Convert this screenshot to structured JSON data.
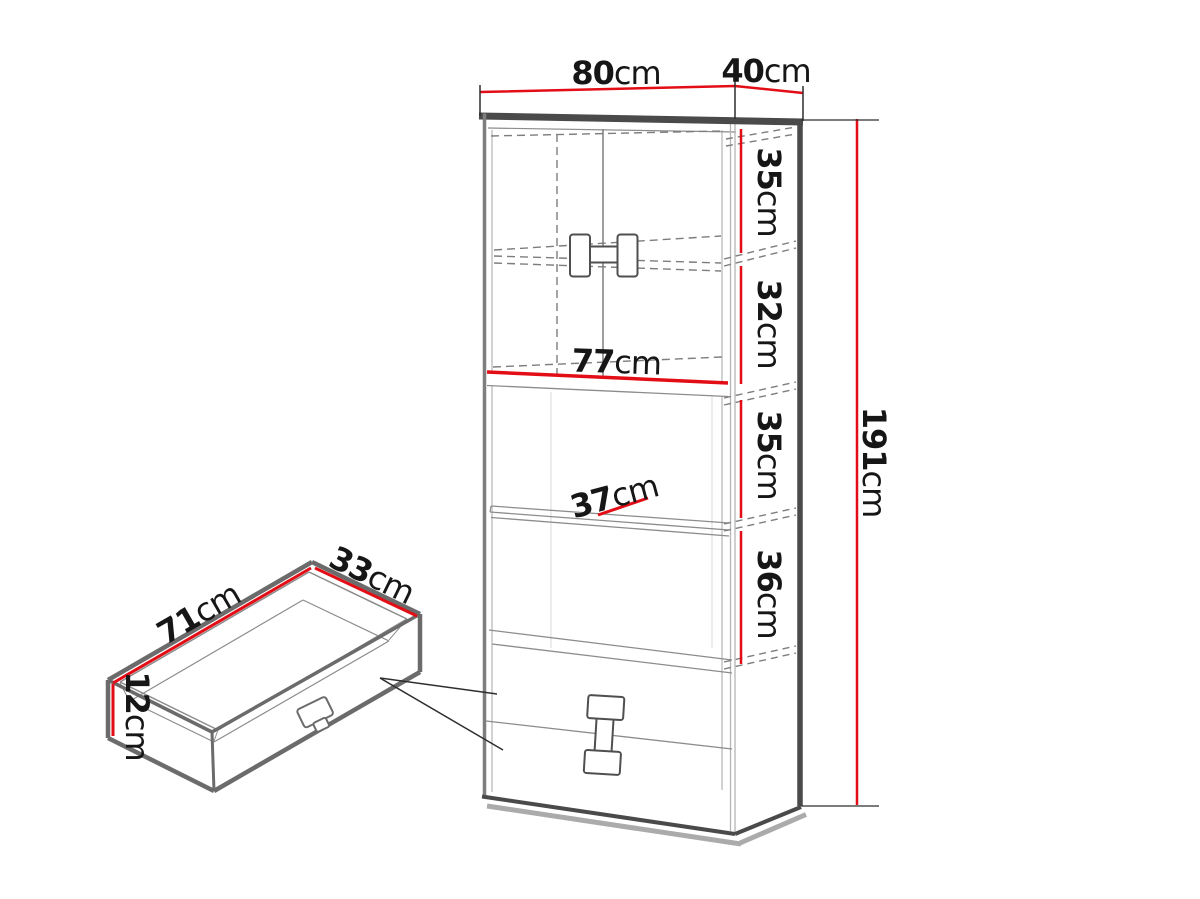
{
  "diagram": {
    "unit": "cm",
    "cabinet": {
      "width_label": {
        "value": "80",
        "unit": "cm"
      },
      "depth_label": {
        "value": "40",
        "unit": "cm"
      },
      "height_label": {
        "value": "191",
        "unit": "cm"
      },
      "inner_width_label": {
        "value": "77",
        "unit": "cm"
      },
      "shelf_depth_label": {
        "value": "37",
        "unit": "cm"
      },
      "sections": [
        {
          "value": "35",
          "unit": "cm"
        },
        {
          "value": "32",
          "unit": "cm"
        },
        {
          "value": "35",
          "unit": "cm"
        },
        {
          "value": "36",
          "unit": "cm"
        }
      ]
    },
    "drawer": {
      "width_label": {
        "value": "71",
        "unit": "cm"
      },
      "depth_label": {
        "value": "33",
        "unit": "cm"
      },
      "height_label": {
        "value": "12",
        "unit": "cm"
      }
    },
    "colors": {
      "dimension_red": "#e30d16",
      "edge_dark": "#4a4a4a",
      "edge_medium": "#7e7e7e",
      "line_thin": "#8c8c8c",
      "text_color": "#161616",
      "background": "#ffffff"
    }
  }
}
